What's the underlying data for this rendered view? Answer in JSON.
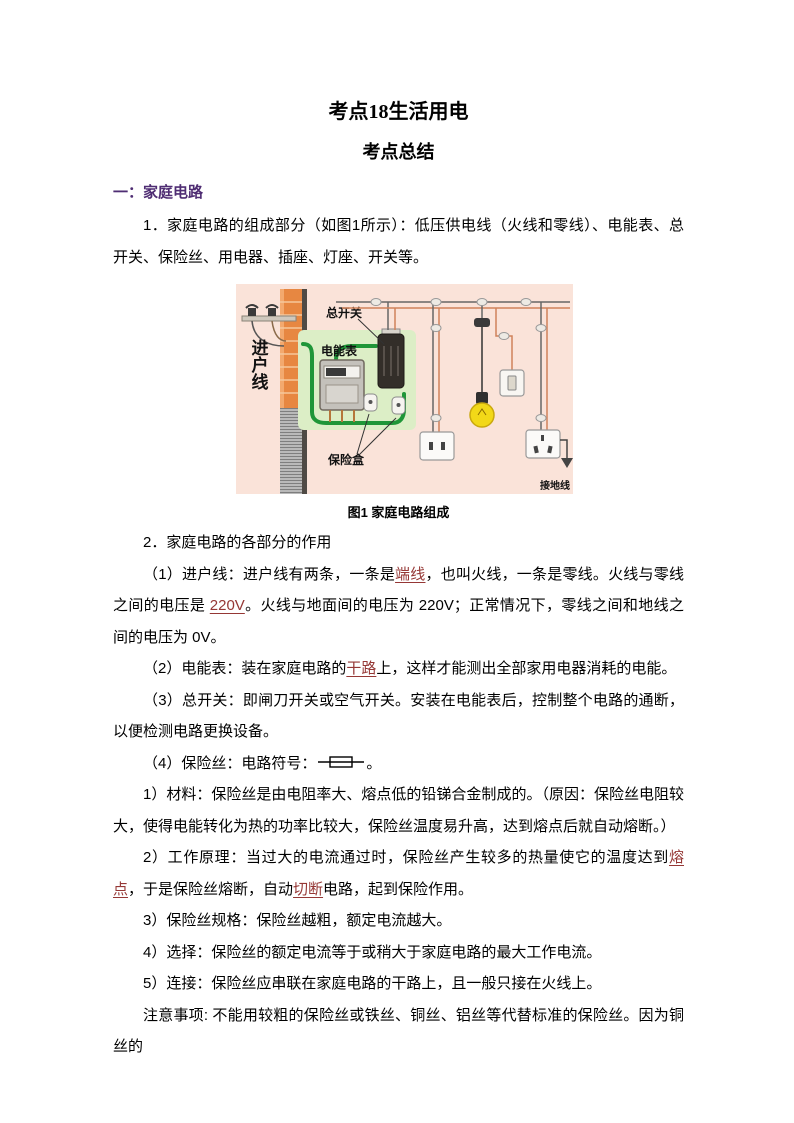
{
  "page": {
    "title": "考点18生活用电",
    "subtitle": "考点总结"
  },
  "section1": {
    "heading": "一：家庭电路",
    "para1": "1．家庭电路的组成部分（如图1所示）：低压供电线（火线和零线）、电能表、总开关、保险丝、用电器、插座、灯座、开关等。"
  },
  "figure": {
    "caption": "图1 家庭电路组成",
    "labels": {
      "incoming_line": "进户线",
      "main_switch": "总开关",
      "energy_meter": "电能表",
      "fuse_box": "保险盒",
      "ground_wire": "接地线"
    },
    "colors": {
      "background": "#FAE3D9",
      "brick": "#E78741",
      "panel_green": "#DCEEC6",
      "wire_green": "#1F9638",
      "wire_orange": "#D0825A",
      "bulb_yellow": "#F2D818"
    }
  },
  "icons": {
    "fuse_symbol": "horizontal line through rectangle (circuit fuse symbol)"
  },
  "content": {
    "p2_heading": "2．家庭电路的各部分的作用",
    "item1": {
      "runs": [
        {
          "t": "（1）进户线：进户线有两条，一条是"
        },
        {
          "t": "端线"
        },
        {
          "t": "，也叫火线，一条是零线。火线与零线之间的电压是 "
        },
        {
          "t": "220V"
        },
        {
          "t": "。火线与地面间的电压为 220V；正常情况下，零线之间和地线之间的电压为 0V。"
        }
      ]
    },
    "item2": {
      "runs": [
        {
          "t": "（2）电能表：装在家庭电路的"
        },
        {
          "t": "干路"
        },
        {
          "t": "上，这样才能测出全部家用电器消耗的电能。"
        }
      ]
    },
    "item3": "（3）总开关：即闸刀开关或空气开关。安装在电能表后，控制整个电路的通断，以便检测电路更换设备。",
    "item4": {
      "before_symbol": "（4）保险丝：电路符号：",
      "after_symbol": "。"
    },
    "sub1": "1）材料：保险丝是由电阻率大、熔点低的铅锑合金制成的。（原因：保险丝电阻较大，使得电能转化为热的功率比较大，保险丝温度易升高，达到熔点后就自动熔断。）",
    "sub2": {
      "runs": [
        {
          "t": "2）工作原理：当过大的电流通过时，保险丝产生较多的热量使它的温度达到"
        },
        {
          "t": "熔点"
        },
        {
          "t": "，于是保险丝熔断，自动"
        },
        {
          "t": "切断"
        },
        {
          "t": "电路，起到保险作用。"
        }
      ]
    },
    "sub3": "3）保险丝规格：保险丝越粗，额定电流越大。",
    "sub4": "4）选择：保险丝的额定电流等于或稍大于家庭电路的最大工作电流。",
    "sub5": "5）连接：保险丝应串联在家庭电路的干路上，且一般只接在火线上。",
    "note": "注意事项: 不能用较粗的保险丝或铁丝、铜丝、铝丝等代替标准的保险丝。因为铜丝的"
  }
}
